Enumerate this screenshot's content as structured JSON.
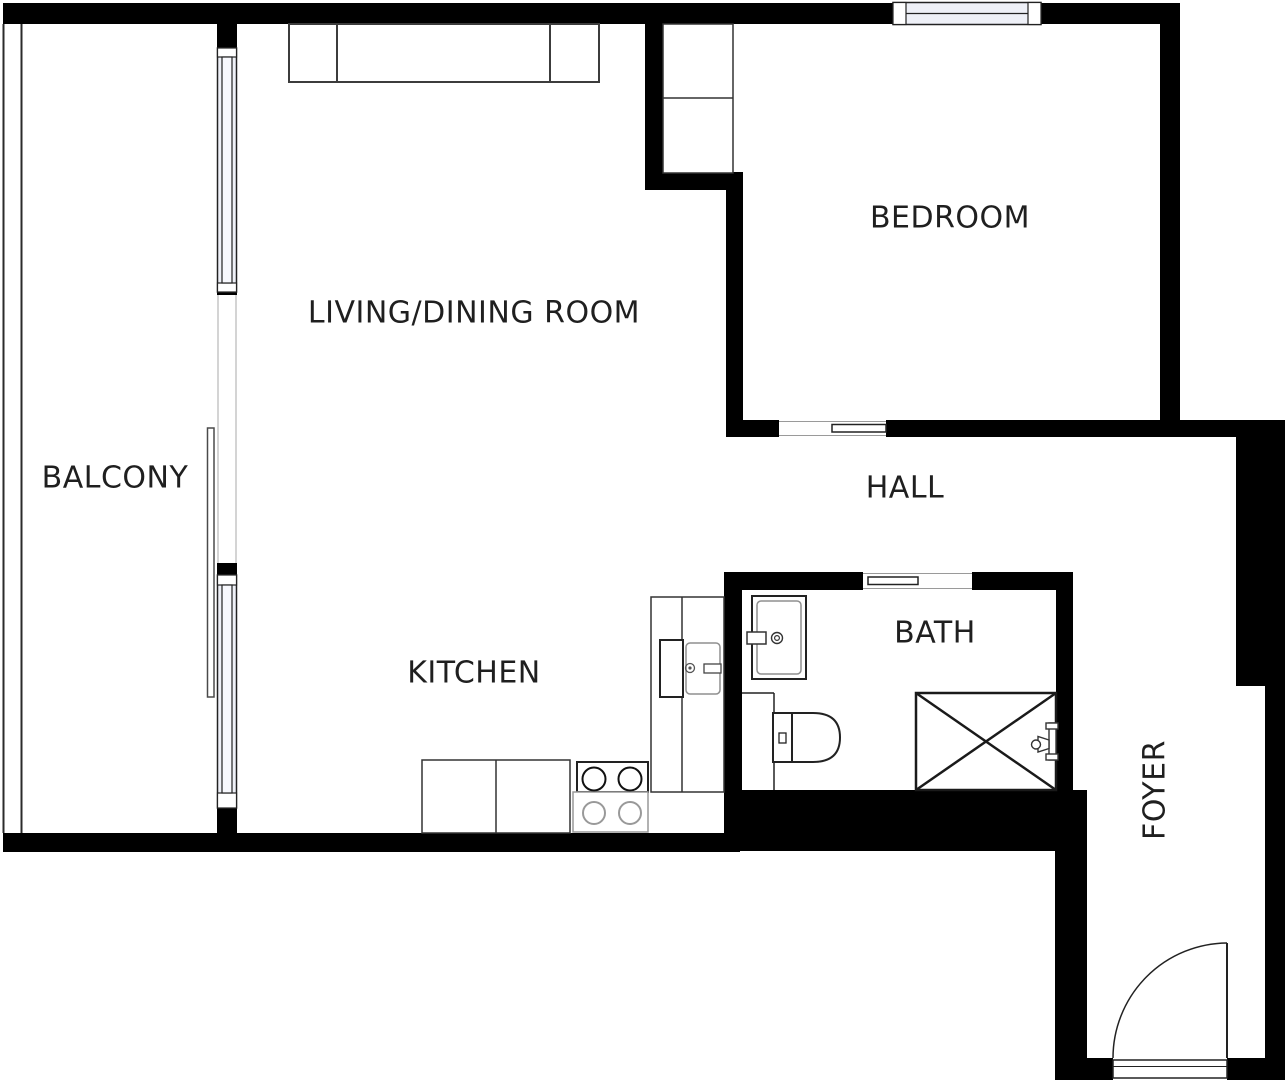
{
  "plan": {
    "rooms": [
      {
        "id": "balcony",
        "label": "BALCONY"
      },
      {
        "id": "living-dining",
        "label": "LIVING/DINING ROOM"
      },
      {
        "id": "bedroom",
        "label": "BEDROOM"
      },
      {
        "id": "hall",
        "label": "HALL"
      },
      {
        "id": "kitchen",
        "label": "KITCHEN"
      },
      {
        "id": "bath",
        "label": "BATH"
      },
      {
        "id": "foyer",
        "label": "FOYER"
      }
    ],
    "fixtures": [
      "sofa",
      "wardrobe",
      "bedroom-window",
      "balcony-windows",
      "balcony-railing",
      "sliding-door-leaf",
      "kitchen-counter",
      "kitchen-sink",
      "stove",
      "base-cabinets",
      "bathroom-vanity",
      "toilet",
      "shower",
      "entry-door"
    ],
    "colors": {
      "wall": "#000000",
      "line": "#2b2b2b",
      "muted_line": "#8f8f8f",
      "window_fill": "#eef0f7",
      "background": "#ffffff",
      "text": "#1f1f1f"
    }
  }
}
